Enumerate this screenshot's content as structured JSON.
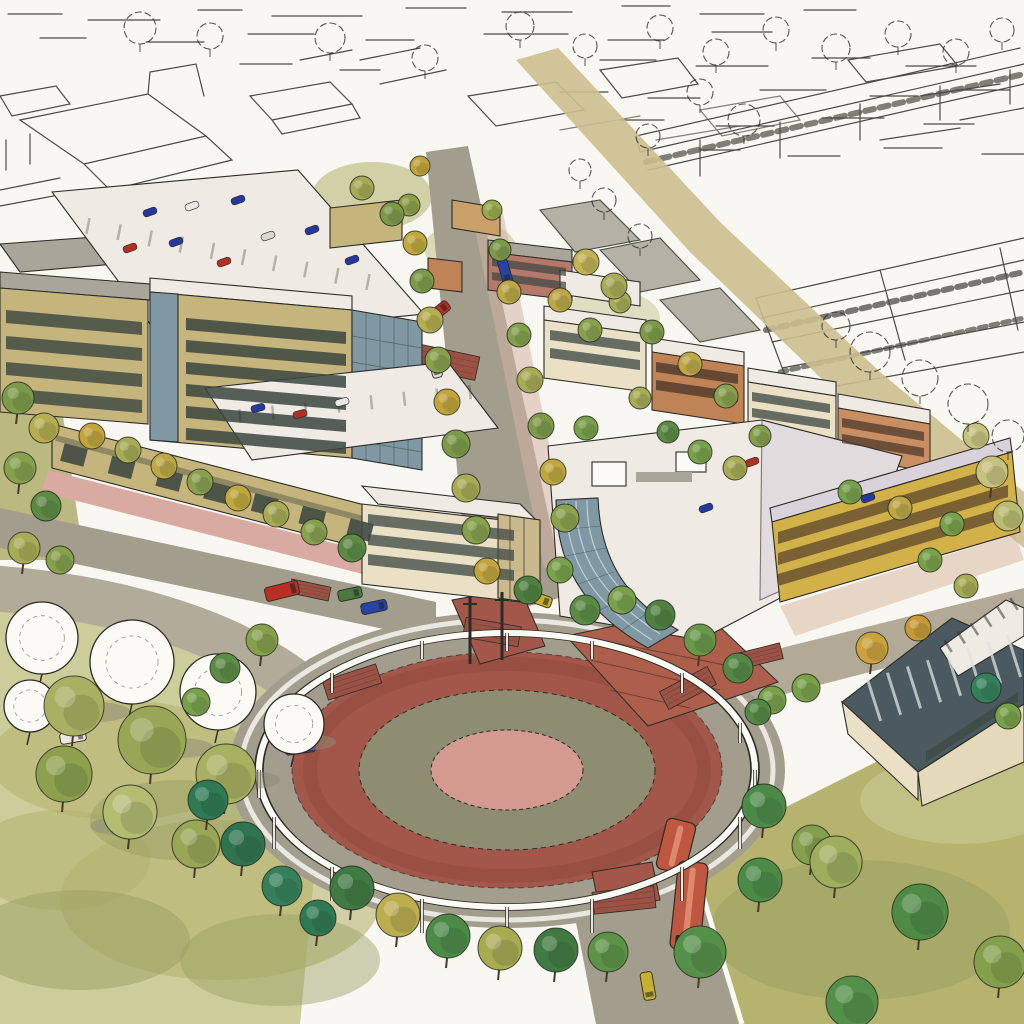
{
  "meta": {
    "artwork_type": "watercolor and pen-and-ink architectural rendering",
    "view": "aerial perspective of a mixed-use town center",
    "visible_text": "none"
  },
  "palette": {
    "paper": "#f8f7f1",
    "ink": "#2c2c26",
    "white": "#fbfaf5",
    "roadGray": "#a39d8d",
    "roadLight": "#b3ab9a",
    "tanRoad": "#ccbe8e",
    "brickRed": "#a2574a",
    "brickDark": "#8c4638",
    "crosswalkBrick": "#9b5244",
    "plazaBrick": "#ad5f4c",
    "oliveRing": "#8e8d72",
    "pinkCenter": "#d49a90",
    "parkPale": "#cdcd9b",
    "lawnOlive": "#b5b36e",
    "lawnDark": "#9aa061",
    "khaki": "#c5b47c",
    "cream": "#e9e0c6",
    "yellowFacade": "#d2b148",
    "orangeBrick": "#c08356",
    "orangeBrickLight": "#c98f62",
    "pinkBrick": "#b5796b",
    "roofWhite": "#efeae4",
    "roofGray": "#aaa59b",
    "roofLavender": "#d9d2da",
    "glassBlue": "#7f98a4",
    "glassDark": "#4a5a60",
    "windowDark": "#39463f",
    "windowBrown": "#6b5430",
    "sidewalkPink": "#d9aaa2",
    "sidewalkTan": "#d9cdb8",
    "shadow": "#6f6a5f"
  },
  "landmarks": [
    {
      "name": "traffic-circle",
      "description": "large oval roundabout with red brick circulating ring, olive landscaped ring and rose center, encircled by a white elevated trellis ring on slender posts"
    },
    {
      "name": "trolley",
      "description": "red two-car trolley entering the circle from the south street with a yellow car behind it"
    },
    {
      "name": "main-street",
      "description": "tree-lined main street running north from the circle between the building blocks"
    },
    {
      "name": "left-office-block",
      "description": "khaki office buildings with dark window bands, rooftop parking decks with parked cars, and a ground-floor retail arcade with pink sidewalk"
    },
    {
      "name": "right-mixed-use-block",
      "description": "curved glass corner building with white roof terraces and yellow apartment wings over brick townhouse rows"
    },
    {
      "name": "glass-pavilion",
      "description": "pavilion with dark striped glass roof and clerestory at the lower right"
    },
    {
      "name": "unfinished-sketch",
      "description": "pen-outline city blocks, parking garages and trees left uncolored across the top and right of the sheet"
    }
  ],
  "vehicles": [
    {
      "x": 300,
      "y": 747,
      "rot": -8,
      "len": 30,
      "wid": 13,
      "color": "#2743a6"
    },
    {
      "x": 282,
      "y": 591,
      "rot": -14,
      "len": 34,
      "wid": 14,
      "color": "#b92f23"
    },
    {
      "x": 350,
      "y": 594,
      "rot": -12,
      "len": 24,
      "wid": 11,
      "color": "#4a7a40"
    },
    {
      "x": 374,
      "y": 607,
      "rot": -12,
      "len": 26,
      "wid": 11,
      "color": "#2743a6"
    },
    {
      "x": 438,
      "y": 312,
      "rot": -38,
      "len": 26,
      "wid": 11,
      "color": "#b92f23"
    },
    {
      "x": 505,
      "y": 271,
      "rot": 74,
      "len": 24,
      "wid": 10,
      "color": "#2743a6"
    },
    {
      "x": 435,
      "y": 366,
      "rot": 74,
      "len": 24,
      "wid": 10,
      "color": "#dcdcd4"
    },
    {
      "x": 539,
      "y": 599,
      "rot": 20,
      "len": 26,
      "wid": 11,
      "color": "#c8b02e"
    },
    {
      "x": 648,
      "y": 986,
      "rot": 80,
      "len": 28,
      "wid": 12,
      "color": "#c8b02e"
    },
    {
      "x": 73,
      "y": 737,
      "rot": -10,
      "len": 26,
      "wid": 11,
      "color": "#e8e8e0"
    }
  ],
  "rooftop_cars": [
    {
      "x": 150,
      "y": 212,
      "rot": -20,
      "color": "#2438a0"
    },
    {
      "x": 192,
      "y": 206,
      "rot": -20,
      "color": "#e8e8e4"
    },
    {
      "x": 238,
      "y": 200,
      "rot": -20,
      "color": "#2438a0"
    },
    {
      "x": 130,
      "y": 248,
      "rot": -20,
      "color": "#b03028"
    },
    {
      "x": 176,
      "y": 242,
      "rot": -20,
      "color": "#2438a0"
    },
    {
      "x": 268,
      "y": 236,
      "rot": -20,
      "color": "#d8d8d2"
    },
    {
      "x": 312,
      "y": 230,
      "rot": -20,
      "color": "#2438a0"
    },
    {
      "x": 224,
      "y": 262,
      "rot": -20,
      "color": "#b03028"
    },
    {
      "x": 352,
      "y": 260,
      "rot": -20,
      "color": "#2438a0"
    },
    {
      "x": 300,
      "y": 414,
      "rot": -15,
      "color": "#b03028"
    },
    {
      "x": 258,
      "y": 408,
      "rot": -15,
      "color": "#2438a0"
    },
    {
      "x": 342,
      "y": 402,
      "rot": -15,
      "color": "#e8e8e4"
    },
    {
      "x": 706,
      "y": 508,
      "rot": -20,
      "color": "#2438a0"
    },
    {
      "x": 752,
      "y": 462,
      "rot": -20,
      "color": "#b03028"
    },
    {
      "x": 868,
      "y": 498,
      "rot": -20,
      "color": "#2438a0"
    }
  ],
  "trolley": {
    "color": "#bf5640",
    "roof": "#df8f72",
    "windshield": "#242a2c",
    "segments": [
      {
        "x": 676,
        "y": 846,
        "len": 52,
        "wid": 30,
        "rot": 104,
        "windshield": false
      },
      {
        "x": 689,
        "y": 906,
        "len": 88,
        "wid": 30,
        "rot": 96,
        "windshield": true
      }
    ]
  },
  "crosswalks": [
    {
      "x": 492,
      "y": 632,
      "w": 56,
      "h": 20,
      "rot": 10
    },
    {
      "x": 352,
      "y": 682,
      "w": 56,
      "h": 20,
      "rot": -18
    },
    {
      "x": 624,
      "y": 900,
      "w": 62,
      "h": 22,
      "rot": -6
    },
    {
      "x": 688,
      "y": 688,
      "w": 54,
      "h": 20,
      "rot": -28
    },
    {
      "x": 760,
      "y": 656,
      "w": 44,
      "h": 16,
      "rot": -14
    },
    {
      "x": 446,
      "y": 362,
      "w": 64,
      "h": 24,
      "rot": 12
    },
    {
      "x": 310,
      "y": 590,
      "w": 40,
      "h": 14,
      "rot": 12
    }
  ],
  "trellis": {
    "cx": 507,
    "cy": 770,
    "rx": 248,
    "ry": 137,
    "poles": [
      [
        259,
        770,
        28
      ],
      [
        755,
        770,
        28
      ],
      [
        740,
        817,
        32
      ],
      [
        682,
        867,
        34
      ],
      [
        592,
        899,
        34
      ],
      [
        507,
        907,
        34
      ],
      [
        422,
        899,
        34
      ],
      [
        332,
        867,
        34
      ],
      [
        274,
        817,
        32
      ],
      [
        274,
        723,
        20
      ],
      [
        332,
        673,
        20
      ],
      [
        422,
        641,
        18
      ],
      [
        507,
        633,
        18
      ],
      [
        592,
        641,
        18
      ],
      [
        682,
        673,
        20
      ],
      [
        740,
        723,
        20
      ]
    ],
    "masts": [
      [
        470,
        596,
        68
      ],
      [
        502,
        592,
        68
      ]
    ]
  },
  "street_trees": [
    {
      "x": 409,
      "y": 205,
      "r": 11,
      "c": "#8fa049"
    },
    {
      "x": 415,
      "y": 243,
      "r": 12,
      "c": "#c0a83e"
    },
    {
      "x": 422,
      "y": 281,
      "r": 12,
      "c": "#7d9a4a"
    },
    {
      "x": 430,
      "y": 320,
      "r": 13,
      "c": "#b5ad52"
    },
    {
      "x": 438,
      "y": 360,
      "r": 13,
      "c": "#89a04e"
    },
    {
      "x": 447,
      "y": 402,
      "r": 13,
      "c": "#c2a33c"
    },
    {
      "x": 456,
      "y": 444,
      "r": 14,
      "c": "#7d9a4a"
    },
    {
      "x": 466,
      "y": 488,
      "r": 14,
      "c": "#a8ab55"
    },
    {
      "x": 476,
      "y": 530,
      "r": 14,
      "c": "#86a04c"
    },
    {
      "x": 487,
      "y": 571,
      "r": 13,
      "c": "#c2a33c"
    },
    {
      "x": 492,
      "y": 210,
      "r": 10,
      "c": "#9aa84f"
    },
    {
      "x": 500,
      "y": 250,
      "r": 11,
      "c": "#7d9a4a"
    },
    {
      "x": 509,
      "y": 292,
      "r": 12,
      "c": "#bda746"
    },
    {
      "x": 519,
      "y": 335,
      "r": 12,
      "c": "#84a04c"
    },
    {
      "x": 530,
      "y": 380,
      "r": 13,
      "c": "#a8ab55"
    },
    {
      "x": 541,
      "y": 426,
      "r": 13,
      "c": "#7d9a4a"
    },
    {
      "x": 553,
      "y": 472,
      "r": 13,
      "c": "#c0a83e"
    },
    {
      "x": 565,
      "y": 518,
      "r": 14,
      "c": "#8aa24d"
    },
    {
      "x": 585,
      "y": 610,
      "r": 15,
      "c": "#5d8a45"
    },
    {
      "x": 622,
      "y": 600,
      "r": 14,
      "c": "#79a04a"
    },
    {
      "x": 660,
      "y": 615,
      "r": 15,
      "c": "#4f8040"
    },
    {
      "x": 700,
      "y": 640,
      "r": 16,
      "c": "#6a984a"
    },
    {
      "x": 738,
      "y": 668,
      "r": 15,
      "c": "#568845"
    },
    {
      "x": 772,
      "y": 700,
      "r": 14,
      "c": "#79a04a"
    },
    {
      "x": 262,
      "y": 640,
      "r": 16,
      "c": "#86a04c"
    },
    {
      "x": 225,
      "y": 668,
      "r": 15,
      "c": "#5d8a45"
    },
    {
      "x": 196,
      "y": 702,
      "r": 14,
      "c": "#79a04a"
    },
    {
      "x": 208,
      "y": 800,
      "r": 20,
      "c": "#2f7a54"
    },
    {
      "x": 243,
      "y": 844,
      "r": 22,
      "c": "#2e7450"
    },
    {
      "x": 282,
      "y": 886,
      "r": 20,
      "c": "#35805a"
    },
    {
      "x": 318,
      "y": 918,
      "r": 18,
      "c": "#2f7a54"
    },
    {
      "x": 352,
      "y": 888,
      "r": 22,
      "c": "#3f7a42"
    },
    {
      "x": 398,
      "y": 915,
      "r": 22,
      "c": "#bcae4e"
    },
    {
      "x": 448,
      "y": 936,
      "r": 22,
      "c": "#4c8a48"
    },
    {
      "x": 500,
      "y": 948,
      "r": 22,
      "c": "#a9ab52"
    },
    {
      "x": 556,
      "y": 950,
      "r": 22,
      "c": "#3f7a42"
    },
    {
      "x": 608,
      "y": 952,
      "r": 20,
      "c": "#5d9348"
    },
    {
      "x": 760,
      "y": 880,
      "r": 22,
      "c": "#4c8a48"
    },
    {
      "x": 812,
      "y": 845,
      "r": 20,
      "c": "#85a04c"
    },
    {
      "x": 700,
      "y": 452,
      "r": 12,
      "c": "#79a04a"
    },
    {
      "x": 735,
      "y": 468,
      "r": 12,
      "c": "#a8ab55"
    },
    {
      "x": 668,
      "y": 432,
      "r": 11,
      "c": "#5d8a45"
    },
    {
      "x": 850,
      "y": 492,
      "r": 12,
      "c": "#79a04a"
    },
    {
      "x": 900,
      "y": 508,
      "r": 12,
      "c": "#bda746"
    },
    {
      "x": 952,
      "y": 524,
      "r": 12,
      "c": "#79a04a"
    },
    {
      "x": 872,
      "y": 648,
      "r": 16,
      "c": "#cda23c"
    },
    {
      "x": 918,
      "y": 628,
      "r": 13,
      "c": "#c89a36"
    },
    {
      "x": 806,
      "y": 688,
      "r": 14,
      "c": "#79a04a"
    },
    {
      "x": 758,
      "y": 712,
      "r": 13,
      "c": "#568845"
    },
    {
      "x": 986,
      "y": 688,
      "r": 15,
      "c": "#35805a"
    },
    {
      "x": 1008,
      "y": 716,
      "r": 13,
      "c": "#79a04a"
    },
    {
      "x": 700,
      "y": 952,
      "r": 26,
      "c": "#55904a"
    },
    {
      "x": 764,
      "y": 806,
      "r": 22,
      "c": "#4c8a48"
    },
    {
      "x": 836,
      "y": 862,
      "r": 26,
      "c": "#9fae5d"
    },
    {
      "x": 920,
      "y": 912,
      "r": 28,
      "c": "#4f8a46"
    },
    {
      "x": 1000,
      "y": 962,
      "r": 26,
      "c": "#85a04c"
    },
    {
      "x": 852,
      "y": 1002,
      "r": 26,
      "c": "#55904a"
    },
    {
      "x": 18,
      "y": 398,
      "r": 16,
      "c": "#7d9a4a"
    },
    {
      "x": 44,
      "y": 428,
      "r": 15,
      "c": "#b5ad52"
    },
    {
      "x": 20,
      "y": 468,
      "r": 16,
      "c": "#86a04c"
    },
    {
      "x": 46,
      "y": 506,
      "r": 15,
      "c": "#5d8a45"
    },
    {
      "x": 24,
      "y": 548,
      "r": 16,
      "c": "#a8ab55"
    },
    {
      "x": 60,
      "y": 560,
      "r": 14,
      "c": "#86a04c"
    },
    {
      "x": 92,
      "y": 436,
      "r": 13,
      "c": "#c2a33c"
    },
    {
      "x": 128,
      "y": 450,
      "r": 13,
      "c": "#a8ab55"
    },
    {
      "x": 164,
      "y": 466,
      "r": 13,
      "c": "#bda746"
    },
    {
      "x": 200,
      "y": 482,
      "r": 13,
      "c": "#89a04e"
    },
    {
      "x": 238,
      "y": 498,
      "r": 13,
      "c": "#c0a83e"
    },
    {
      "x": 276,
      "y": 514,
      "r": 13,
      "c": "#a8ab55"
    },
    {
      "x": 314,
      "y": 532,
      "r": 13,
      "c": "#89a04e"
    },
    {
      "x": 362,
      "y": 188,
      "r": 12,
      "c": "#a8ab55"
    },
    {
      "x": 392,
      "y": 214,
      "r": 12,
      "c": "#7d9a4a"
    },
    {
      "x": 420,
      "y": 166,
      "r": 10,
      "c": "#c2a33c"
    },
    {
      "x": 560,
      "y": 300,
      "r": 12,
      "c": "#bda746"
    },
    {
      "x": 590,
      "y": 330,
      "r": 12,
      "c": "#89a04e"
    },
    {
      "x": 620,
      "y": 302,
      "r": 11,
      "c": "#a8ab55"
    },
    {
      "x": 652,
      "y": 332,
      "r": 12,
      "c": "#7d9a4a"
    },
    {
      "x": 690,
      "y": 364,
      "r": 12,
      "c": "#bda746"
    },
    {
      "x": 726,
      "y": 396,
      "r": 12,
      "c": "#89a04e"
    },
    {
      "x": 586,
      "y": 262,
      "r": 13,
      "c": "#c2b254"
    },
    {
      "x": 614,
      "y": 286,
      "r": 13,
      "c": "#a8ab55"
    },
    {
      "x": 586,
      "y": 428,
      "r": 12,
      "c": "#79a04a"
    },
    {
      "x": 640,
      "y": 398,
      "r": 11,
      "c": "#a8ab55"
    },
    {
      "x": 760,
      "y": 436,
      "r": 11,
      "c": "#85a04c"
    },
    {
      "x": 930,
      "y": 560,
      "r": 12,
      "c": "#79a04a"
    },
    {
      "x": 966,
      "y": 586,
      "r": 12,
      "c": "#a8ab55"
    },
    {
      "x": 352,
      "y": 548,
      "r": 14,
      "c": "#5d8a45"
    },
    {
      "x": 528,
      "y": 590,
      "r": 14,
      "c": "#4f8040"
    },
    {
      "x": 560,
      "y": 570,
      "r": 13,
      "c": "#79a04a"
    },
    {
      "x": 992,
      "y": 472,
      "r": 16,
      "c": "#c6c27e"
    },
    {
      "x": 1008,
      "y": 516,
      "r": 15,
      "c": "#b9bc72"
    },
    {
      "x": 976,
      "y": 436,
      "r": 13,
      "c": "#c6c27e"
    }
  ],
  "sketch_trees": [
    {
      "x": 140,
      "y": 28,
      "r": 16
    },
    {
      "x": 210,
      "y": 36,
      "r": 13
    },
    {
      "x": 330,
      "y": 38,
      "r": 15
    },
    {
      "x": 425,
      "y": 58,
      "r": 13
    },
    {
      "x": 520,
      "y": 26,
      "r": 14
    },
    {
      "x": 585,
      "y": 46,
      "r": 12
    },
    {
      "x": 660,
      "y": 28,
      "r": 13
    },
    {
      "x": 716,
      "y": 52,
      "r": 13
    },
    {
      "x": 776,
      "y": 30,
      "r": 13
    },
    {
      "x": 836,
      "y": 48,
      "r": 14
    },
    {
      "x": 898,
      "y": 34,
      "r": 13
    },
    {
      "x": 956,
      "y": 52,
      "r": 13
    },
    {
      "x": 1002,
      "y": 30,
      "r": 12
    },
    {
      "x": 744,
      "y": 120,
      "r": 16
    },
    {
      "x": 700,
      "y": 92,
      "r": 13
    },
    {
      "x": 648,
      "y": 136,
      "r": 12
    },
    {
      "x": 870,
      "y": 352,
      "r": 20
    },
    {
      "x": 920,
      "y": 378,
      "r": 18
    },
    {
      "x": 968,
      "y": 404,
      "r": 20
    },
    {
      "x": 1008,
      "y": 436,
      "r": 16
    },
    {
      "x": 836,
      "y": 326,
      "r": 14
    },
    {
      "x": 604,
      "y": 200,
      "r": 12
    },
    {
      "x": 640,
      "y": 236,
      "r": 12
    },
    {
      "x": 580,
      "y": 170,
      "r": 11
    }
  ],
  "park_shadows": [
    {
      "x": 96,
      "y": 712,
      "rx": 34,
      "ry": 10
    },
    {
      "x": 178,
      "y": 748,
      "rx": 36,
      "ry": 10
    },
    {
      "x": 250,
      "y": 780,
      "rx": 30,
      "ry": 9
    },
    {
      "x": 120,
      "y": 826,
      "rx": 30,
      "ry": 9
    },
    {
      "x": 310,
      "y": 742,
      "rx": 26,
      "ry": 8
    }
  ],
  "park_trees_outlined": [
    {
      "x": 42,
      "y": 638,
      "r": 36
    },
    {
      "x": 132,
      "y": 662,
      "r": 42
    },
    {
      "x": 218,
      "y": 692,
      "r": 38
    },
    {
      "x": 294,
      "y": 724,
      "r": 30
    },
    {
      "x": 30,
      "y": 706,
      "r": 26
    }
  ],
  "park_trees_colored": [
    {
      "x": 74,
      "y": 706,
      "r": 30,
      "c": "#a9b061"
    },
    {
      "x": 152,
      "y": 740,
      "r": 34,
      "c": "#98a656"
    },
    {
      "x": 64,
      "y": 774,
      "r": 28,
      "c": "#8ca04e"
    },
    {
      "x": 226,
      "y": 774,
      "r": 30,
      "c": "#a9b061"
    },
    {
      "x": 130,
      "y": 812,
      "r": 27,
      "c": "#b4bc72"
    },
    {
      "x": 196,
      "y": 844,
      "r": 24,
      "c": "#98a656"
    }
  ]
}
